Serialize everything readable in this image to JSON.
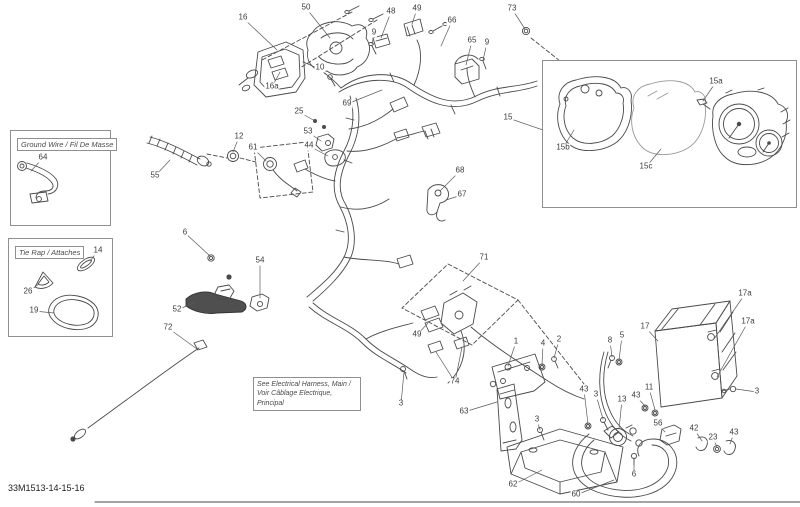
{
  "page": {
    "footer_code": "33M1513-14-15-16"
  },
  "colors": {
    "background": "#ffffff",
    "line": "#4a4a4a",
    "leader": "#5a5a5a",
    "label_text": "#3b3b3b",
    "box_border": "#8f8f8f"
  },
  "boxes": {
    "ground_wire": {
      "label": "Ground Wire / Fil De Masse"
    },
    "tie_rap": {
      "label": "Tie Rap / Attaches"
    },
    "harness_note": {
      "line1": "See Electrical Harness, Main /",
      "line2": "Voir Câblage Electrique, Principal"
    }
  },
  "callouts": [
    {
      "label": "16",
      "x": 243,
      "y": 18,
      "targets": [
        [
          277,
          50
        ]
      ]
    },
    {
      "label": "50",
      "x": 306,
      "y": 8,
      "targets": [
        [
          330,
          38
        ]
      ]
    },
    {
      "label": "48",
      "x": 391,
      "y": 12,
      "targets": [
        [
          381,
          38
        ]
      ]
    },
    {
      "label": "49",
      "x": 417,
      "y": 9,
      "targets": [
        [
          412,
          24
        ]
      ]
    },
    {
      "label": "66",
      "x": 452,
      "y": 21,
      "targets": [
        [
          441,
          46
        ]
      ]
    },
    {
      "label": "73",
      "x": 512,
      "y": 9,
      "targets": [
        [
          525,
          29
        ]
      ]
    },
    {
      "label": "9",
      "x": 374,
      "y": 33,
      "targets": [
        [
          372,
          44
        ]
      ]
    },
    {
      "label": "10",
      "x": 320,
      "y": 68,
      "targets": [
        [
          330,
          78
        ]
      ]
    },
    {
      "label": "16a",
      "x": 272,
      "y": 87,
      "targets": [
        [
          280,
          72
        ]
      ]
    },
    {
      "label": "69",
      "x": 347,
      "y": 104,
      "targets": [
        [
          382,
          90
        ]
      ]
    },
    {
      "label": "65",
      "x": 472,
      "y": 41,
      "targets": [
        [
          466,
          65
        ]
      ]
    },
    {
      "label": "9",
      "x": 487,
      "y": 43,
      "targets": [
        [
          483,
          60
        ]
      ]
    },
    {
      "label": "25",
      "x": 299,
      "y": 112,
      "targets": [
        [
          315,
          121
        ]
      ]
    },
    {
      "label": "53",
      "x": 308,
      "y": 132,
      "targets": [
        [
          321,
          141
        ]
      ]
    },
    {
      "label": "44",
      "x": 309,
      "y": 146,
      "targets": [
        [
          328,
          156
        ]
      ]
    },
    {
      "label": "12",
      "x": 239,
      "y": 137,
      "targets": [
        [
          233,
          152
        ]
      ]
    },
    {
      "label": "61",
      "x": 253,
      "y": 148,
      "targets": [
        [
          266,
          161
        ]
      ]
    },
    {
      "label": "55",
      "x": 155,
      "y": 176,
      "targets": [
        [
          170,
          160
        ]
      ]
    },
    {
      "label": "64",
      "x": 43,
      "y": 158,
      "targets": [
        [
          31,
          171
        ]
      ]
    },
    {
      "label": "14",
      "x": 98,
      "y": 251,
      "targets": [
        [
          90,
          261
        ]
      ]
    },
    {
      "label": "26",
      "x": 28,
      "y": 292,
      "targets": [
        [
          39,
          284
        ]
      ]
    },
    {
      "label": "19",
      "x": 34,
      "y": 311,
      "targets": [
        [
          54,
          313
        ]
      ]
    },
    {
      "label": "6",
      "x": 185,
      "y": 233,
      "targets": [
        [
          210,
          256
        ]
      ]
    },
    {
      "label": "54",
      "x": 260,
      "y": 261,
      "targets": [
        [
          260,
          298
        ]
      ]
    },
    {
      "label": "52",
      "x": 177,
      "y": 310,
      "targets": [
        [
          194,
          303
        ]
      ]
    },
    {
      "label": "72",
      "x": 168,
      "y": 328,
      "targets": [
        [
          197,
          349
        ]
      ]
    },
    {
      "label": "68",
      "x": 460,
      "y": 171,
      "targets": [
        [
          440,
          191
        ]
      ]
    },
    {
      "label": "67",
      "x": 462,
      "y": 195,
      "targets": [
        [
          446,
          200
        ]
      ]
    },
    {
      "label": "71",
      "x": 484,
      "y": 258,
      "targets": [
        [
          463,
          281
        ]
      ]
    },
    {
      "label": "49",
      "x": 417,
      "y": 335,
      "targets": [
        [
          428,
          323
        ]
      ]
    },
    {
      "label": "74",
      "x": 455,
      "y": 382,
      "targets": [
        [
          436,
          352
        ],
        [
          462,
          347
        ]
      ]
    },
    {
      "label": "3",
      "x": 401,
      "y": 404,
      "targets": [
        [
          404,
          372
        ]
      ]
    },
    {
      "label": "63",
      "x": 464,
      "y": 412,
      "targets": [
        [
          497,
          402
        ]
      ]
    },
    {
      "label": "1",
      "x": 516,
      "y": 342,
      "targets": [
        [
          508,
          366
        ]
      ]
    },
    {
      "label": "4",
      "x": 543,
      "y": 344,
      "targets": [
        [
          542,
          365
        ]
      ]
    },
    {
      "label": "2",
      "x": 559,
      "y": 340,
      "targets": [
        [
          554,
          358
        ]
      ]
    },
    {
      "label": "8",
      "x": 610,
      "y": 341,
      "targets": [
        [
          612,
          357
        ]
      ]
    },
    {
      "label": "5",
      "x": 622,
      "y": 336,
      "targets": [
        [
          619,
          360
        ]
      ]
    },
    {
      "label": "43",
      "x": 584,
      "y": 390,
      "targets": [
        [
          588,
          424
        ]
      ]
    },
    {
      "label": "3",
      "x": 596,
      "y": 395,
      "targets": [
        [
          603,
          419
        ]
      ]
    },
    {
      "label": "13",
      "x": 622,
      "y": 400,
      "targets": [
        [
          619,
          429
        ]
      ]
    },
    {
      "label": "43",
      "x": 636,
      "y": 396,
      "targets": [
        [
          645,
          406
        ]
      ]
    },
    {
      "label": "11",
      "x": 649,
      "y": 388,
      "targets": [
        [
          655,
          410
        ]
      ]
    },
    {
      "label": "56",
      "x": 658,
      "y": 424,
      "targets": [
        [
          665,
          432
        ]
      ]
    },
    {
      "label": "3",
      "x": 537,
      "y": 420,
      "targets": [
        [
          540,
          430
        ]
      ]
    },
    {
      "label": "6",
      "x": 634,
      "y": 475,
      "targets": [
        [
          634,
          459
        ]
      ]
    },
    {
      "label": "62",
      "x": 513,
      "y": 485,
      "targets": [
        [
          542,
          470
        ]
      ]
    },
    {
      "label": "60",
      "x": 576,
      "y": 495,
      "targets": [
        [
          614,
          480
        ]
      ]
    },
    {
      "label": "17",
      "x": 645,
      "y": 327,
      "targets": [
        [
          658,
          341
        ]
      ]
    },
    {
      "label": "17a",
      "x": 745,
      "y": 294,
      "targets": [
        [
          714,
          339
        ]
      ]
    },
    {
      "label": "17a",
      "x": 748,
      "y": 322,
      "targets": [
        [
          717,
          377
        ]
      ]
    },
    {
      "label": "3",
      "x": 757,
      "y": 392,
      "targets": [
        [
          736,
          389
        ]
      ]
    },
    {
      "label": "15",
      "x": 508,
      "y": 118,
      "targets": [
        [
          543,
          130
        ]
      ]
    },
    {
      "label": "15a",
      "x": 716,
      "y": 82,
      "targets": [
        [
          703,
          101
        ]
      ]
    },
    {
      "label": "15b",
      "x": 563,
      "y": 148,
      "targets": [
        [
          574,
          130
        ]
      ]
    },
    {
      "label": "15c",
      "x": 646,
      "y": 167,
      "targets": [
        [
          661,
          149
        ]
      ]
    },
    {
      "label": "42",
      "x": 694,
      "y": 429,
      "targets": [
        [
          702,
          441
        ]
      ]
    },
    {
      "label": "23",
      "x": 713,
      "y": 438,
      "targets": [
        [
          717,
          447
        ]
      ]
    },
    {
      "label": "43",
      "x": 734,
      "y": 433,
      "targets": [
        [
          730,
          444
        ]
      ]
    }
  ]
}
